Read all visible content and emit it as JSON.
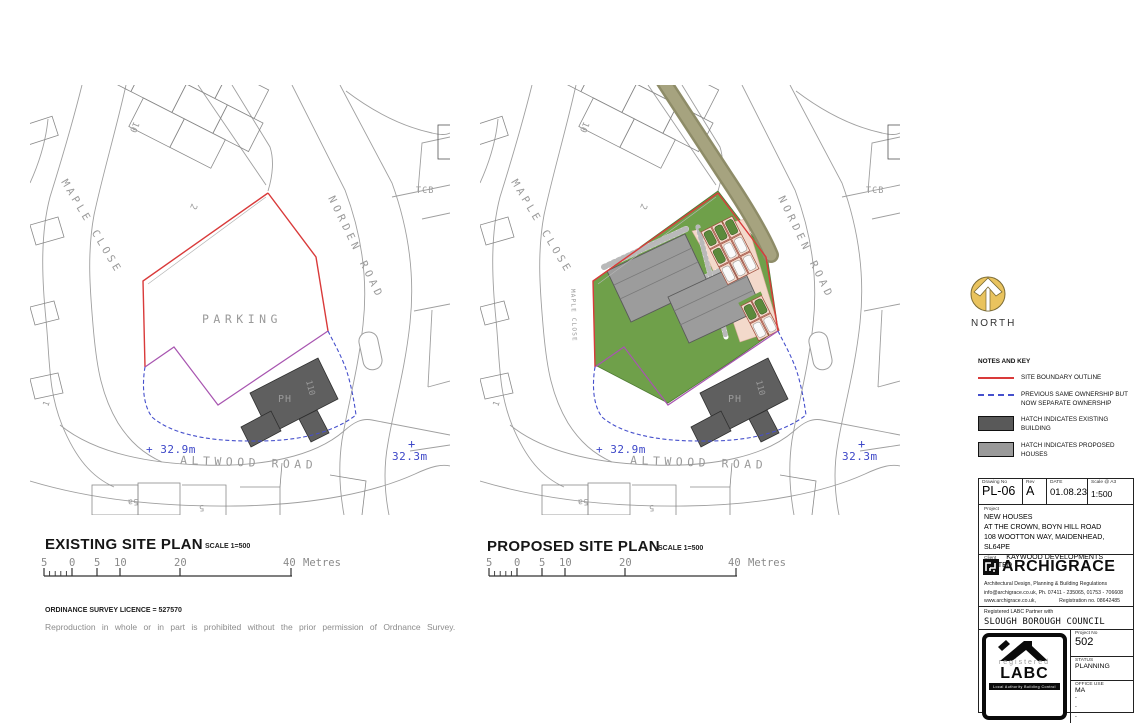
{
  "existing_plan": {
    "title": "EXISTING SITE PLAN",
    "scale_note": "SCALE 1=500"
  },
  "proposed_plan": {
    "title": "PROPOSED SITE PLAN",
    "scale_note": "SCALE 1=500"
  },
  "map": {
    "parking": "PARKING",
    "maple_close": "MAPLE CLOSE",
    "maple_close_small": "MAPLE CLOSE",
    "norden_road": "NORDEN ROAD",
    "altwood_road": "ALTWOOD ROAD",
    "tcb": "TCB",
    "ph": "PH",
    "house_110": "110",
    "plot_10": "10",
    "plot_2": "2",
    "plot_1": "1",
    "plot_5a": "5a",
    "plot_5": "5",
    "spot_level_1": "+ 32.9m",
    "spot_level_2_plus": "+",
    "spot_level_2": "32.3m"
  },
  "scale_bar": {
    "t0": "5",
    "t1": "0",
    "t2": "5",
    "t3": "10",
    "t4": "20",
    "t5": "40",
    "unit": "Metres"
  },
  "os": {
    "licence": "ORDINANCE SURVEY LICENCE = 527570",
    "note": "Reproduction in whole or in part is prohibited without the prior permission of Ordnance Survey."
  },
  "north": {
    "label": "NORTH"
  },
  "legend": {
    "heading": "NOTES AND KEY",
    "items": [
      {
        "label": "SITE BOUNDARY OUTLINE"
      },
      {
        "label": "PREVIOUS SAME OWNERSHIP BUT NOW SEPARATE OWNERSHIP"
      },
      {
        "label": "HATCH INDICATES EXISTING BUILDING"
      },
      {
        "label": "HATCH INDICATES PROPOSED HOUSES"
      }
    ]
  },
  "title_block": {
    "drawing_no_label": "Drawing No",
    "drawing_no": "PL-06",
    "rev_label": "Rev",
    "rev": "A",
    "date_label": "DATE",
    "date": "01.08.23",
    "scale_label": "Scale @ A3",
    "scale": "1:500",
    "project_label": "Project",
    "project_line1": "NEW HOUSES",
    "project_line2": "AT THE CROWN, BOYN HILL ROAD",
    "project_line3": "108 WOOTTON WAY, MAIDENHEAD, SL64PE",
    "client_label": "Client",
    "client": "KAYWOOD DEVELOPMENTS LIMITED",
    "firm_name": "ARCHIGRACE",
    "firm_tagline": "Architectural Design, Planning & Building Regulations",
    "firm_contact": "info@archigrace.co.uk, Ph. 07411 - 235065, 01753 - 706608",
    "firm_web": "www.archigrace.co.uk,",
    "firm_reg": "Registration no. 08642485",
    "labc_partner_note": "Registered LABC Partner with",
    "council": "SLOUGH BOROUGH COUNCIL",
    "labc_registered": "registered",
    "labc_name": "LABC",
    "labc_strip": "Local Authority Building Control",
    "project_no_label": "Project No",
    "project_no": "502",
    "status_label": "STATUS",
    "status": "PLANNING",
    "office_use_label": "OFFICE USE",
    "office_use": "MA",
    "dash1": "-",
    "dash2": "-",
    "dash3": "-"
  },
  "colors": {
    "site_boundary_red": "#d93a3a",
    "prev_ownership_purple": "#a855b0",
    "separate_ownership_blue": "#4650cc",
    "existing_building_grey": "#595959",
    "proposed_house_grey": "#9a9a9a",
    "landscaping_green": "#6fa04a",
    "parking_court_pink": "#f3d9cb",
    "hedge_olive": "#8e8c68",
    "north_arrow_gold": "#e9c35e",
    "spot_level_blue": "#3d47c8"
  }
}
